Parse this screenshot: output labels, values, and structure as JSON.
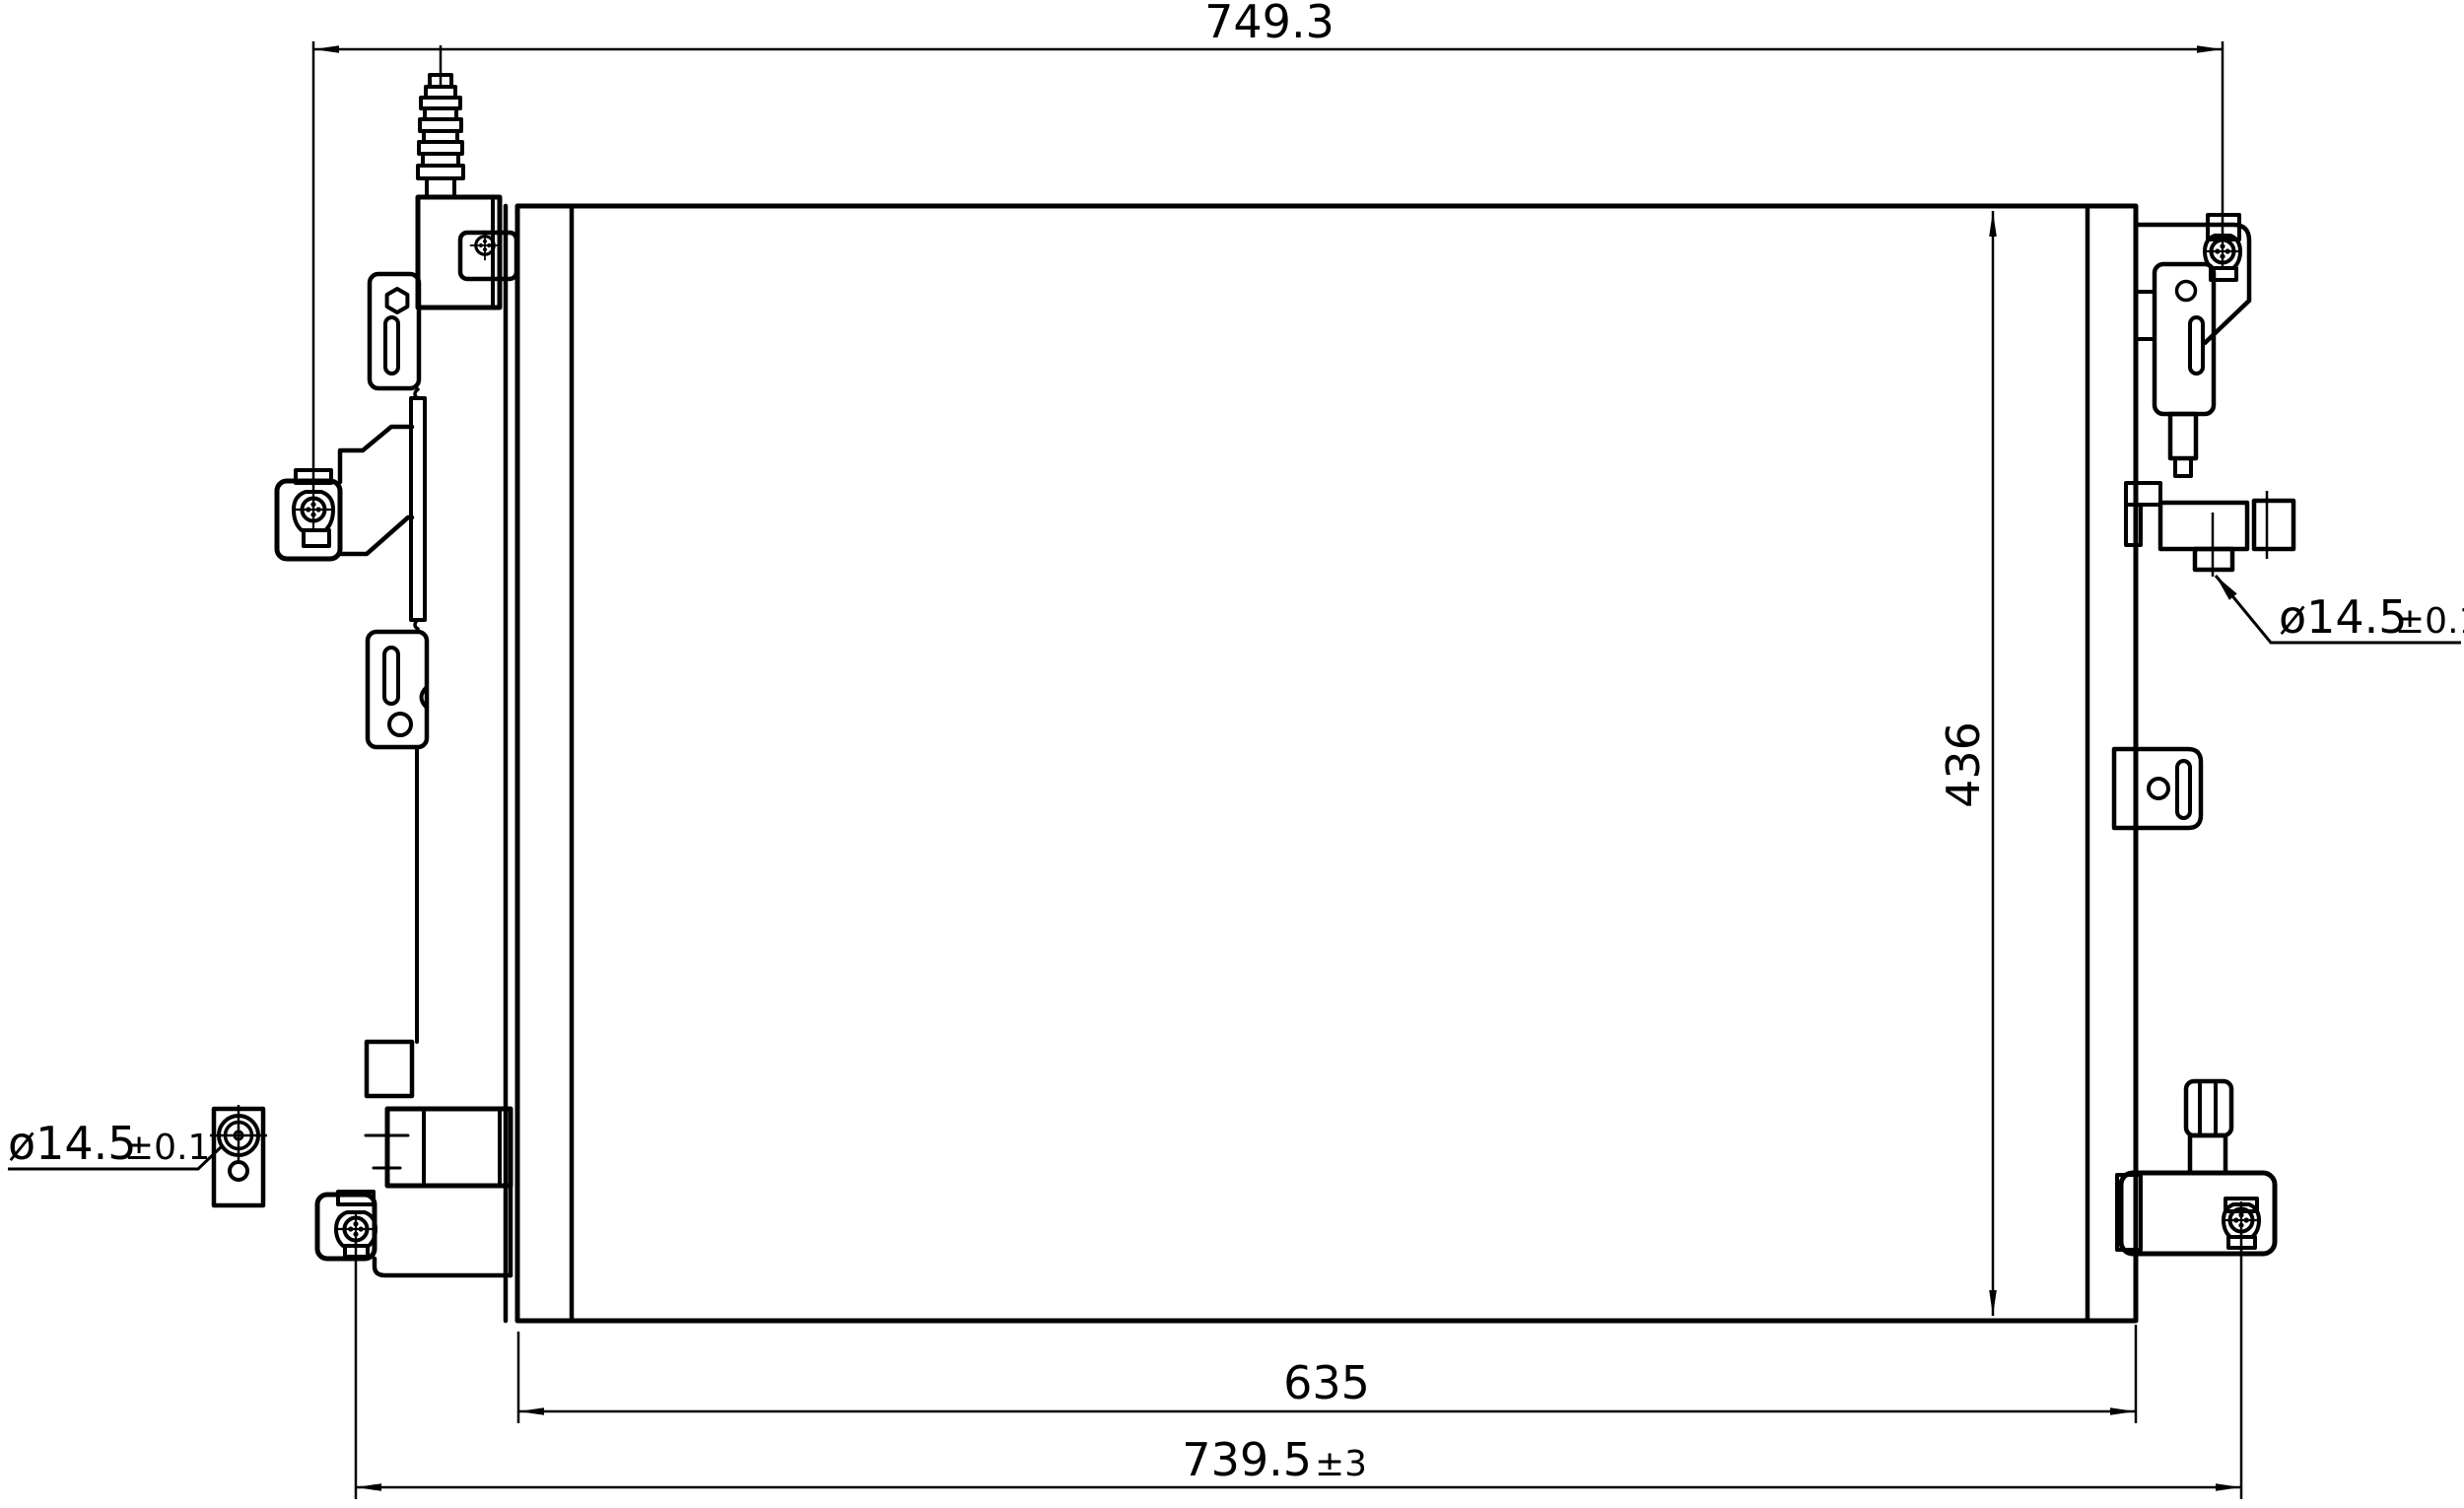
{
  "drawing": {
    "description": "Condenser outline dimensional drawing",
    "background_color": "#ffffff",
    "line_color": "#000000"
  },
  "dimensions": {
    "overall_width": {
      "value": "749.3"
    },
    "core_height": {
      "value": "436"
    },
    "core_width": {
      "value": "635"
    },
    "mounting_width": {
      "value": "739.5",
      "tolerance": "±3"
    },
    "left_port_diameter": {
      "value": "ø14.5",
      "tolerance": "±0.1"
    },
    "right_port_diameter": {
      "value": "ø14.5",
      "tolerance": "±0.1"
    }
  }
}
